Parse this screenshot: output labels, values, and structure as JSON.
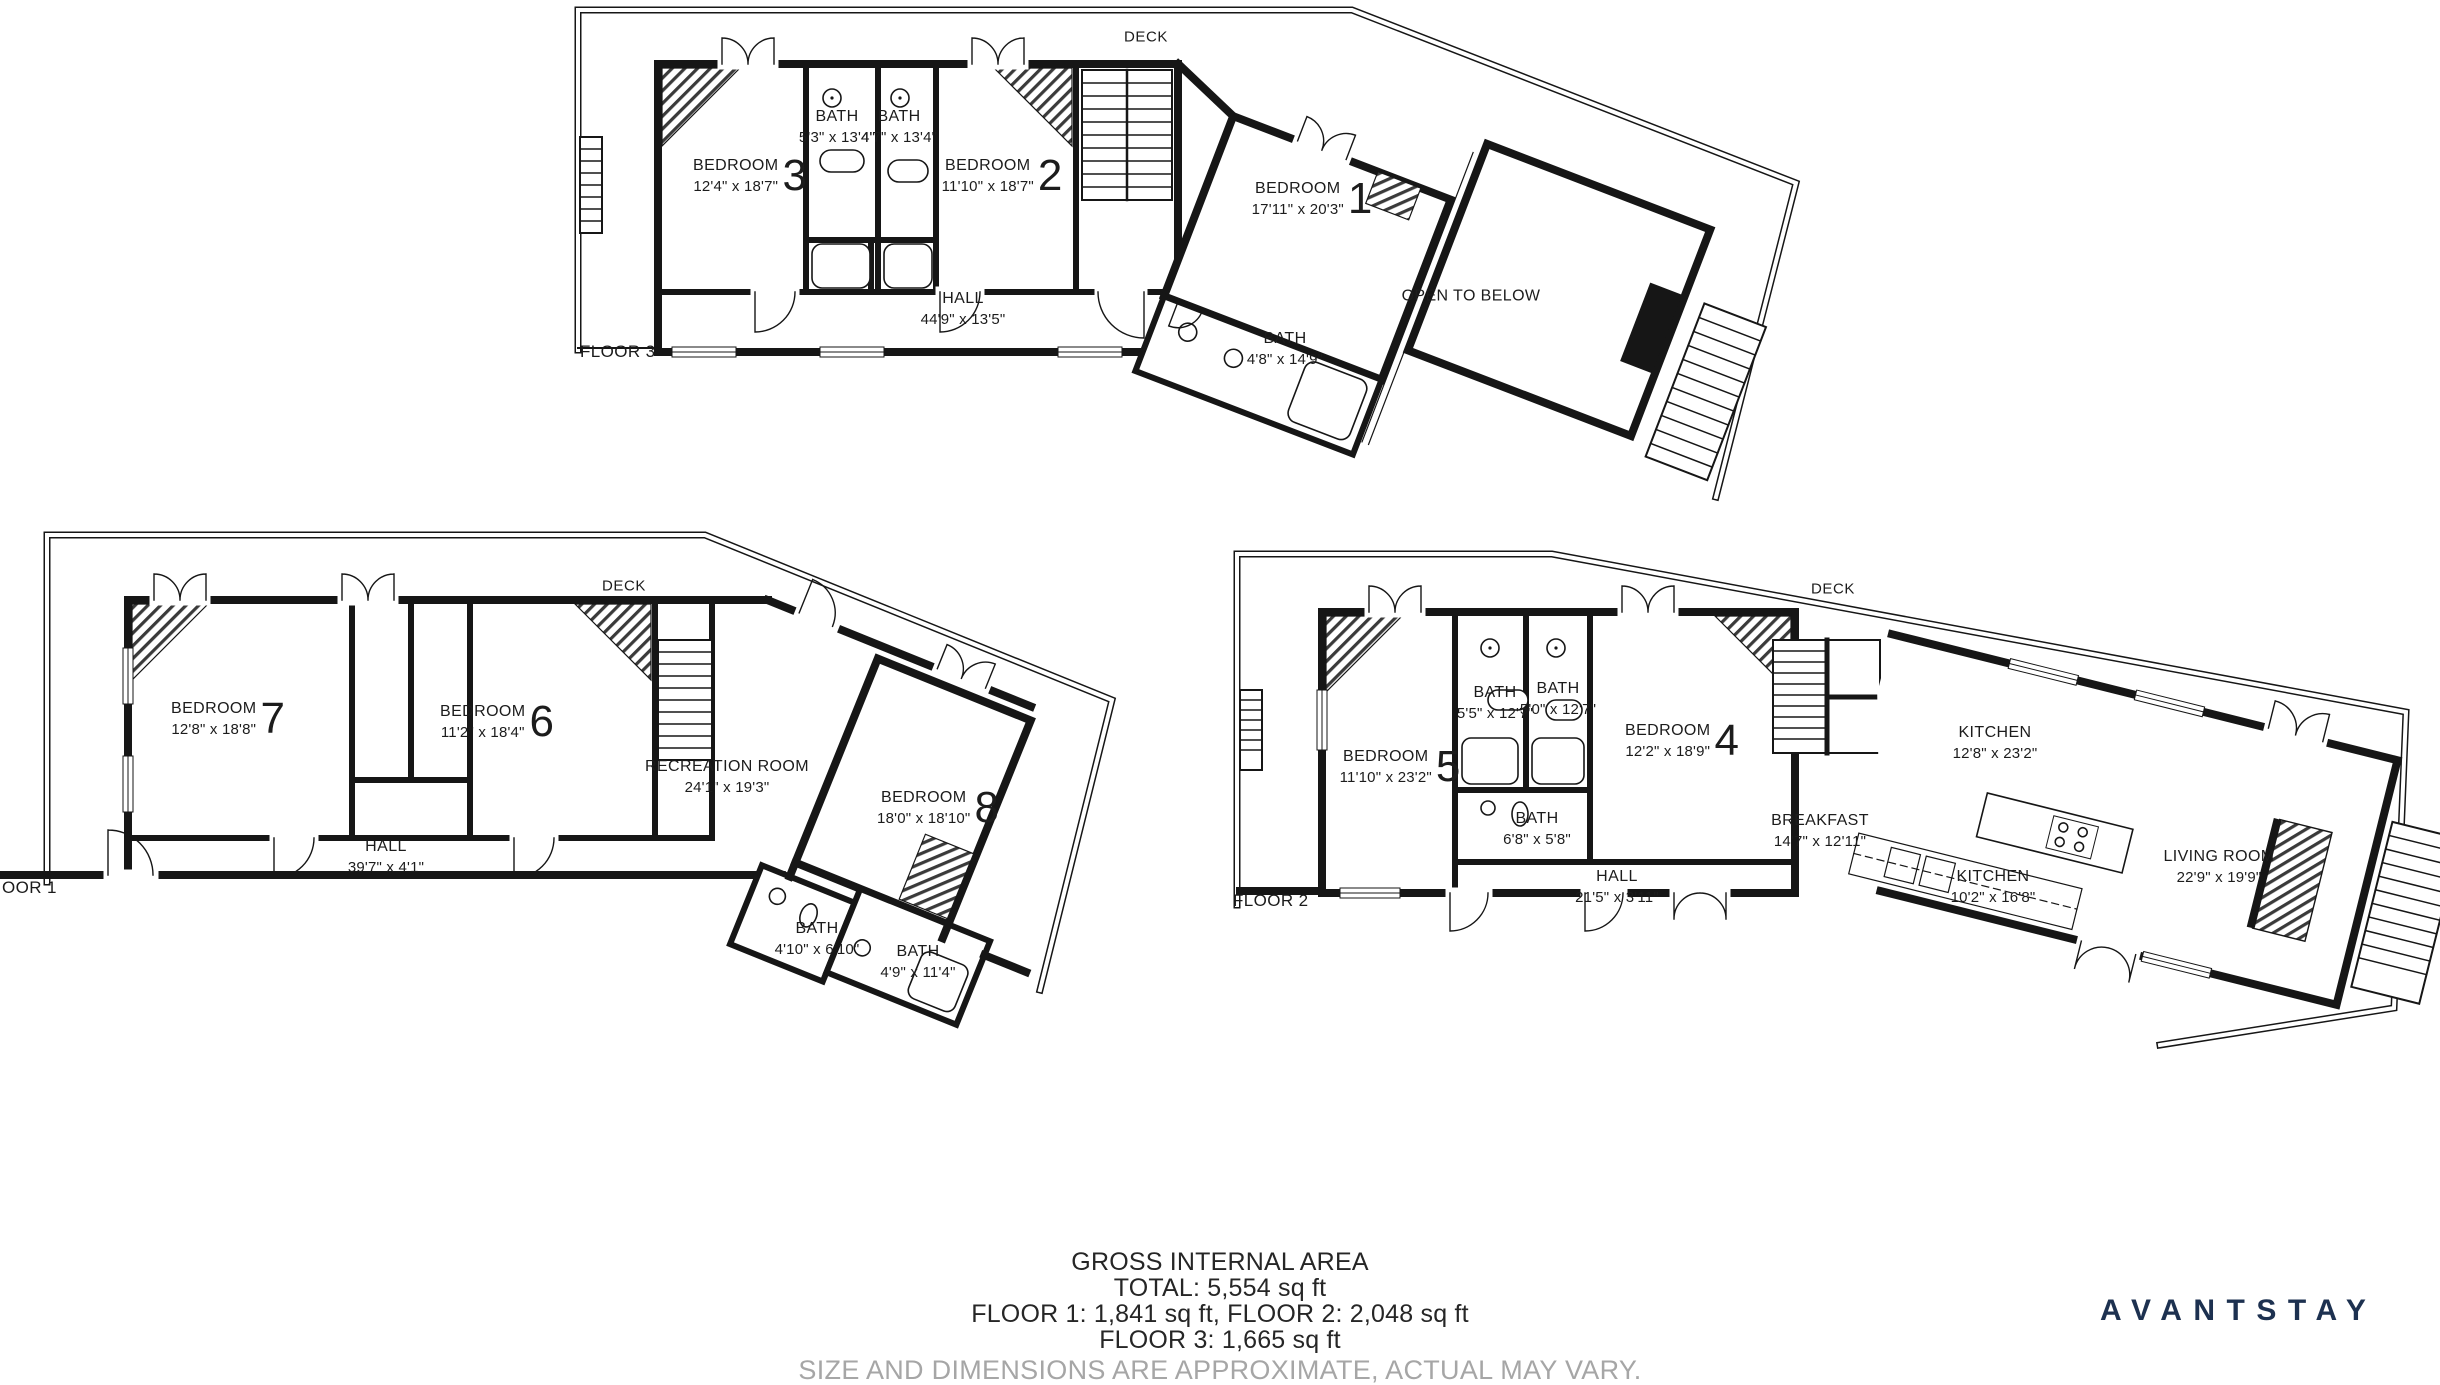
{
  "floors": [
    {
      "id": "floor3",
      "label": "FLOOR 3",
      "deck": "DECK",
      "rooms": [
        {
          "name": "BEDROOM",
          "number": "3",
          "dims": "12'4\" x 18'7\""
        },
        {
          "name": "BATH",
          "dims": "5'3\" x 13'4\""
        },
        {
          "name": "BATH",
          "dims": "4'7\" x 13'4\""
        },
        {
          "name": "BEDROOM",
          "number": "2",
          "dims": "11'10\" x 18'7\""
        },
        {
          "name": "BEDROOM",
          "number": "1",
          "dims": "17'11\" x 20'3\""
        },
        {
          "name": "HALL",
          "dims": "44'9\" x 13'5\""
        },
        {
          "name": "BATH",
          "dims": "4'8\" x 14'9\""
        },
        {
          "name": "OPEN TO BELOW",
          "dims": ""
        }
      ]
    },
    {
      "id": "floor1",
      "label": "OOR 1",
      "deck": "DECK",
      "rooms": [
        {
          "name": "BEDROOM",
          "number": "7",
          "dims": "12'8\" x 18'8\""
        },
        {
          "name": "BEDROOM",
          "number": "6",
          "dims": "11'2\" x 18'4\""
        },
        {
          "name": "RECREATION ROOM",
          "dims": "24'1\" x 19'3\""
        },
        {
          "name": "BEDROOM",
          "number": "8",
          "dims": "18'0\" x 18'10\""
        },
        {
          "name": "HALL",
          "dims": "39'7\" x 4'1\""
        },
        {
          "name": "BATH",
          "dims": "4'10\" x 6'10\""
        },
        {
          "name": "BATH",
          "dims": "4'9\" x 11'4\""
        }
      ]
    },
    {
      "id": "floor2",
      "label": "FLOOR 2",
      "deck": "DECK",
      "rooms": [
        {
          "name": "BEDROOM",
          "number": "5",
          "dims": "11'10\" x 23'2\""
        },
        {
          "name": "BATH",
          "dims": "5'5\" x 12'7\""
        },
        {
          "name": "BATH",
          "dims": "5'0\" x 12'7\""
        },
        {
          "name": "BEDROOM",
          "number": "4",
          "dims": "12'2\" x 18'9\""
        },
        {
          "name": "BATH",
          "dims": "6'8\" x 5'8\""
        },
        {
          "name": "HALL",
          "dims": "21'5\" x 3'11\""
        },
        {
          "name": "KITCHEN",
          "dims": "12'8\" x 23'2\""
        },
        {
          "name": "BREAKFAST",
          "dims": "14'7\" x 12'11\""
        },
        {
          "name": "KITCHEN",
          "dims": "10'2\" x 16'8\""
        },
        {
          "name": "LIVING ROOM",
          "dims": "22'9\" x 19'9\""
        }
      ]
    }
  ],
  "footer": {
    "line1": "GROSS INTERNAL AREA",
    "line2": "TOTAL: 5,554 sq ft",
    "line3": "FLOOR 1: 1,841 sq ft, FLOOR 2: 2,048 sq ft",
    "line4": "FLOOR 3: 1,665 sq ft",
    "disclaimer": "SIZE AND DIMENSIONS ARE APPROXIMATE, ACTUAL MAY VARY."
  },
  "brand": {
    "name": "AVANTSTAY",
    "color": "#1d3150"
  }
}
